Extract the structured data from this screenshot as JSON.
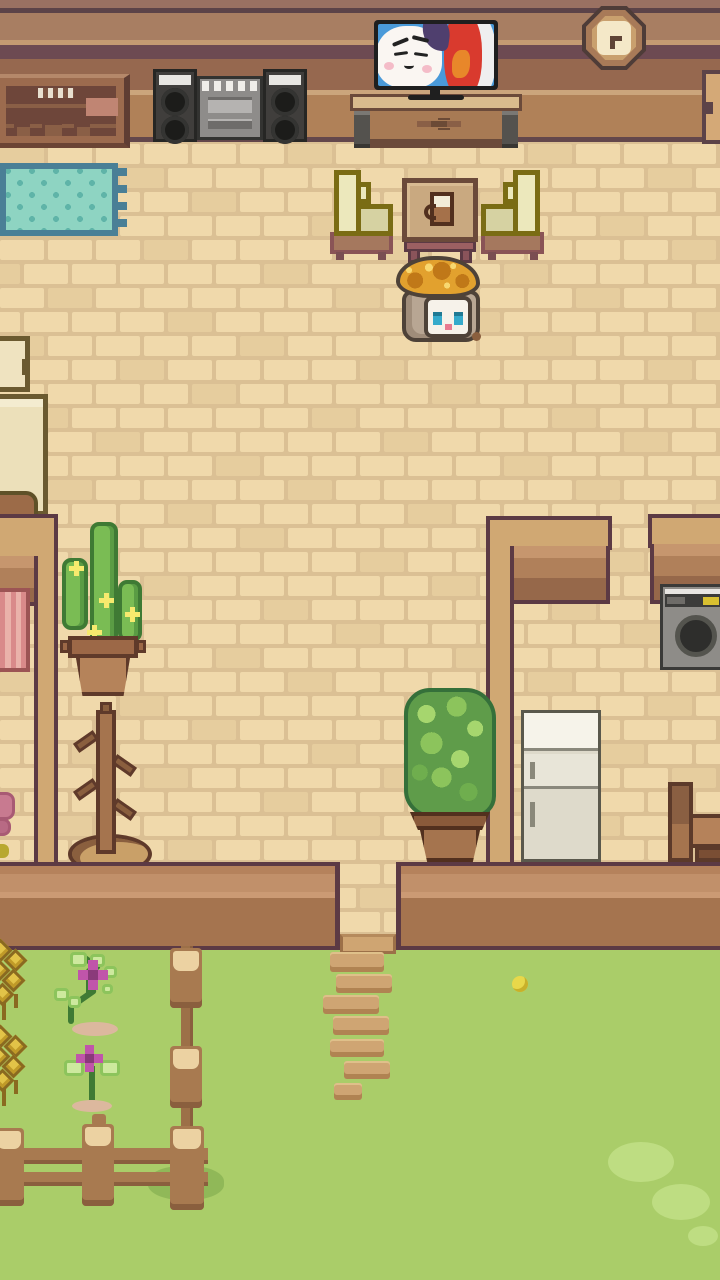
{
  "app": {
    "type": "pixel-art life-sim game",
    "scene": "cat cottage interior with front yard",
    "visible_text": ""
  },
  "palette": {
    "floor_brick": "#f0d9ab",
    "floor_brick_shaded": "#e6cd9e",
    "floor_mortar": "#dbc094",
    "back_wall_wood": "#a87e62",
    "back_wall_stripe_dark": "#6d4a52",
    "wall_top_tan": "#d0a873",
    "wall_face_plank": "#b0805a",
    "outline_dark": "#5c3a44",
    "grass": "#aacd69",
    "grass_light": "#bedd82",
    "grass_shadow": "#90b858",
    "fence_wood": "#a87a50",
    "fence_cap": "#ecd2a2",
    "stone_tan": "#cfa573",
    "rug_teal": "#8ed4c2",
    "rug_border": "#4a7f96",
    "chair_olive": "#7a6c14",
    "chair_cushion": "#ece8bc",
    "hat_gold": "#e2a12e",
    "cat_eye_blue": "#35aacb",
    "flower_magenta": "#c055aa",
    "cactus_green": "#7abc54",
    "tv_screen_blue": "#4a9ad9",
    "washer_accent_yellow": "#d9c030"
  },
  "entities": {
    "back_wall": {
      "label": "wood plank back wall"
    },
    "floor": {
      "label": "tan brick floor"
    },
    "cabinet": {
      "label": "wall cabinet with shelves and drawers"
    },
    "stereo": {
      "label": "boombox stereo with twin speakers"
    },
    "tv": {
      "label": "flat-screen TV playing cartoon face"
    },
    "tv_stand": {
      "label": "wooden TV stand"
    },
    "clock": {
      "label": "octagonal wooden wall clock"
    },
    "right_cabinet": {
      "label": "cabinet partially visible at right edge"
    },
    "rug": {
      "label": "teal fringed rug"
    },
    "armchair_left": {
      "label": "olive armchair facing right"
    },
    "armchair_right": {
      "label": "olive armchair facing left"
    },
    "side_table": {
      "label": "square table with mug"
    },
    "player": {
      "label": "white-faced cat wearing golden curly wig"
    },
    "stove": {
      "label": "cream masonry oven"
    },
    "cactus": {
      "label": "potted cactus with yellow blossoms"
    },
    "pink_bed": {
      "label": "pink cushion at left edge"
    },
    "coat_rack": {
      "label": "branch coat rack on round base"
    },
    "pink_flower": {
      "label": "pink flower at left edge"
    },
    "houseplant": {
      "label": "tall potted houseplant"
    },
    "fridge": {
      "label": "two-door refrigerator"
    },
    "washer": {
      "label": "front-load washing machine"
    },
    "wooden_chair": {
      "label": "small wooden chair"
    },
    "walls": {
      "label": "room divider walls"
    },
    "front_wall": {
      "label": "front wall of house with door opening"
    },
    "door_sill": {
      "label": "door step"
    },
    "stepping_stones": {
      "label": "stepping-stone path",
      "rects": [
        [
          330,
          952,
          54,
          20
        ],
        [
          336,
          974,
          56,
          19
        ],
        [
          323,
          995,
          56,
          19
        ],
        [
          333,
          1016,
          56,
          19
        ],
        [
          330,
          1039,
          54,
          18
        ],
        [
          344,
          1061,
          46,
          18
        ],
        [
          334,
          1083,
          28,
          17
        ]
      ]
    },
    "wheat_top": {
      "label": "golden wheat stalks"
    },
    "wheat_bottom": {
      "label": "golden wheat stalks"
    },
    "flower_vine": {
      "label": "vine with magenta bloom"
    },
    "flower_small": {
      "label": "magenta flower with leaf pair"
    },
    "flower_yellow": {
      "label": "small yellow bloom"
    },
    "fence_vertical": {
      "label": "vertical fence post run"
    },
    "fence_horizontal": {
      "label": "horizontal fence with rails"
    },
    "grass_patches": {
      "label": "light grass patches"
    }
  }
}
